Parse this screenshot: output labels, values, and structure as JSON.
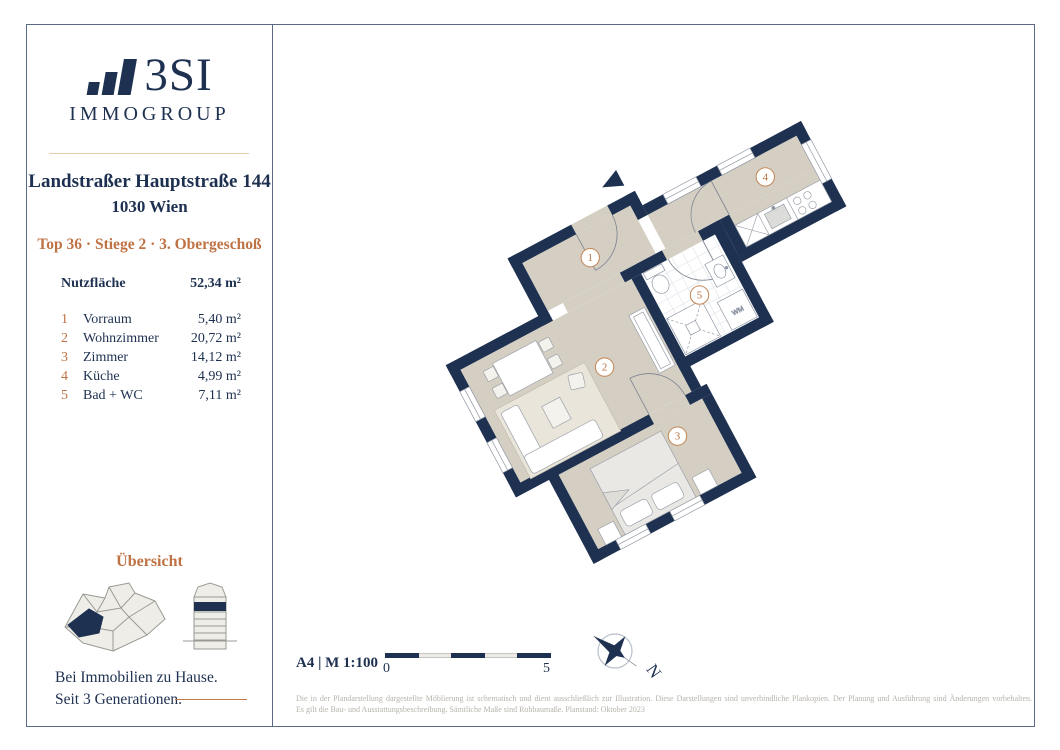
{
  "brand": {
    "logo_text": "3SI",
    "logo_sub": "IMMOGROUP",
    "tagline_line1": "Bei Immobilien zu Hause.",
    "tagline_line2": "Seit 3 Generationen."
  },
  "header": {
    "address": "Landstraßer Hauptstraße 144",
    "city": "1030 Wien",
    "unit_info": "Top 36 · Stiege 2 · 3. Obergeschoß"
  },
  "area_table": {
    "header_label": "Nutzfläche",
    "header_value": "52,34 m²",
    "rows": [
      {
        "num": "1",
        "name": "Vorraum",
        "value": "5,40 m²"
      },
      {
        "num": "2",
        "name": "Wohnzimmer",
        "value": "20,72 m²"
      },
      {
        "num": "3",
        "name": "Zimmer",
        "value": "14,12 m²"
      },
      {
        "num": "4",
        "name": "Küche",
        "value": "4,99 m²"
      },
      {
        "num": "5",
        "name": "Bad + WC",
        "value": "7,11 m²"
      }
    ]
  },
  "overview": {
    "title": "Übersicht"
  },
  "plan": {
    "room_labels": [
      "1",
      "2",
      "3",
      "4",
      "5"
    ],
    "wm_label": "WM",
    "north_label": "N"
  },
  "footer": {
    "format_scale": "A4 | M 1:100",
    "scale_start": "0",
    "scale_end": "5",
    "disclaimer_line1": "Die in der Plandarstellung dargestellte Möblierung ist schematisch und dient ausschließlich zur Illustration. Diese Darstellungen sind unverbindliche Plankopien. Der Planung und Ausführung sind Änderungen vorbehalten.",
    "disclaimer_line2": "Es gilt die Bau- und Ausstattungsbeschreibung. Sämtliche Maße sind Rohbaumaße. Planstand: Oktober 2023"
  },
  "colors": {
    "navy": "#1e3151",
    "orange_accent": "#bf7244",
    "label_ring": "#c58c5e",
    "label_text": "#b9713f",
    "floor_beige": "#d5cfc3",
    "rug_beige": "#eae5da",
    "frame_line": "#5a6a84",
    "disclaimer_gray": "#b7b3ab"
  }
}
